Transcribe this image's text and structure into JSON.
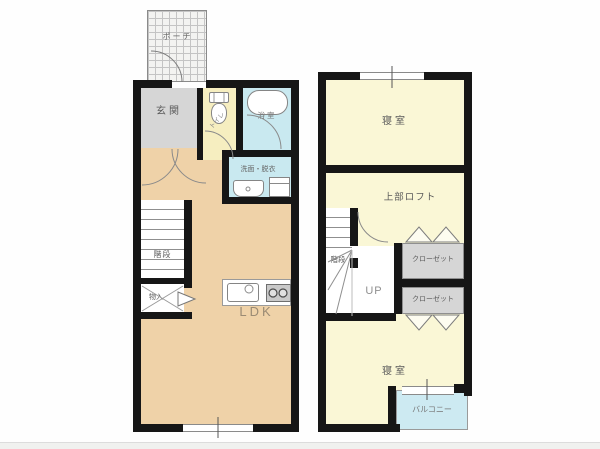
{
  "document_type": "floor-plan",
  "first_floor": {
    "porch_label": "ポーチ",
    "entrance_label": "玄関",
    "toilet_label": "トイレ",
    "bathroom_label": "浴室",
    "washroom_label": "洗面・脱衣",
    "stairs_label": "階段",
    "storage_label": "物入",
    "living_label": "LDK"
  },
  "second_floor": {
    "bedroom_top_label": "寝室",
    "loft_label": "上部ロフト",
    "stairs_label": "階段",
    "up_label": "UP",
    "closet_upper_label": "クローゼット",
    "closet_lower_label": "クローゼット",
    "bedroom_bottom_label": "寝室",
    "balcony_label": "バルコニー"
  },
  "colors": {
    "wall": "#161616",
    "ldk_floor": "#efd2a8",
    "entrance_gray": "#d6d6d6",
    "closet_gray": "#d6d6d6",
    "toilet_yellow": "#f6eec0",
    "room_yellow": "#faf7d6",
    "water_cyan": "#c9e9f0",
    "balcony_cyan": "#cdeaf2",
    "porch_tile": "#f3f3f1"
  }
}
